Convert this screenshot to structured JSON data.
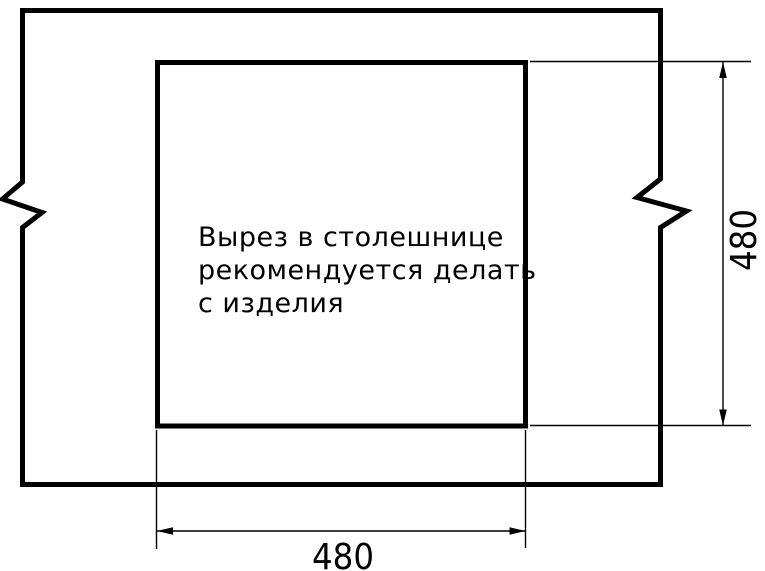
{
  "drawing": {
    "note_lines": [
      "Вырез в столешнице",
      "рекомендуется делать",
      "с изделия"
    ],
    "dimensions": {
      "width_label": "480",
      "height_label": "480"
    },
    "colors": {
      "line_color": "#000000",
      "background": "#ffffff"
    }
  }
}
